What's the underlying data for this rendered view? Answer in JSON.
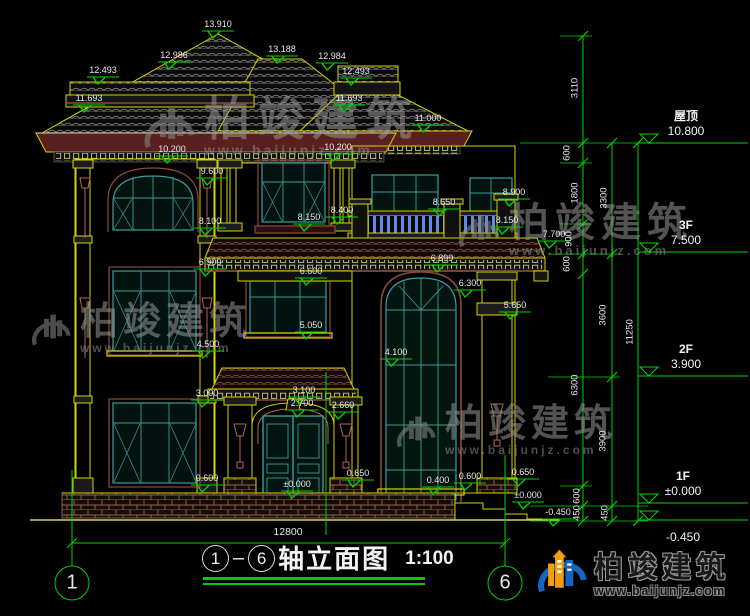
{
  "drawing_title": {
    "axis_from": "1",
    "axis_to": "6",
    "name": "轴立面图",
    "scale": "1:100"
  },
  "axis_bubbles": [
    {
      "label": "1",
      "x": 72,
      "y": 583
    },
    {
      "label": "6",
      "x": 505,
      "y": 583
    }
  ],
  "bottom_dimension": {
    "text": "12800"
  },
  "elevation_markers": [
    {
      "t": "13.910",
      "x": 218,
      "y": 25
    },
    {
      "t": "12.986",
      "x": 174,
      "y": 56
    },
    {
      "t": "13.188",
      "x": 282,
      "y": 50
    },
    {
      "t": "12.984",
      "x": 332,
      "y": 57
    },
    {
      "t": "12.493",
      "x": 103,
      "y": 71
    },
    {
      "t": "12.493",
      "x": 356,
      "y": 72
    },
    {
      "t": "11.693",
      "x": 89,
      "y": 99
    },
    {
      "t": "11.693",
      "x": 349,
      "y": 99
    },
    {
      "t": "11.000",
      "x": 428,
      "y": 119
    },
    {
      "t": "10.200",
      "x": 172,
      "y": 150
    },
    {
      "t": "10.200",
      "x": 338,
      "y": 148
    },
    {
      "t": "9.600",
      "x": 212,
      "y": 172
    },
    {
      "t": "8.100",
      "x": 210,
      "y": 222
    },
    {
      "t": "8.150",
      "x": 309,
      "y": 218
    },
    {
      "t": "8.400",
      "x": 342,
      "y": 211
    },
    {
      "t": "8.650",
      "x": 444,
      "y": 203
    },
    {
      "t": "8.900",
      "x": 514,
      "y": 193
    },
    {
      "t": "8.150",
      "x": 507,
      "y": 221
    },
    {
      "t": "7.700",
      "x": 554,
      "y": 235
    },
    {
      "t": "6.900",
      "x": 210,
      "y": 263
    },
    {
      "t": "6.899",
      "x": 442,
      "y": 259
    },
    {
      "t": "6.600",
      "x": 311,
      "y": 272
    },
    {
      "t": "6.300",
      "x": 470,
      "y": 284
    },
    {
      "t": "5.650",
      "x": 515,
      "y": 306
    },
    {
      "t": "5.050",
      "x": 311,
      "y": 326
    },
    {
      "t": "4.500",
      "x": 208,
      "y": 345
    },
    {
      "t": "4.100",
      "x": 396,
      "y": 353
    },
    {
      "t": "3.000",
      "x": 207,
      "y": 394
    },
    {
      "t": "3.100",
      "x": 304,
      "y": 391
    },
    {
      "t": "2.700",
      "x": 302,
      "y": 404
    },
    {
      "t": "2.660",
      "x": 343,
      "y": 406
    },
    {
      "t": "0.600",
      "x": 207,
      "y": 479
    },
    {
      "t": "0.650",
      "x": 358,
      "y": 474
    },
    {
      "t": "0.400",
      "x": 438,
      "y": 481
    },
    {
      "t": "0.600",
      "x": 470,
      "y": 477
    },
    {
      "t": "0.650",
      "x": 523,
      "y": 473
    },
    {
      "t": "±0.000",
      "x": 297,
      "y": 485
    },
    {
      "t": "±0.000",
      "x": 528,
      "y": 496
    },
    {
      "t": "-0.450",
      "x": 558,
      "y": 513
    }
  ],
  "level_markers": [
    {
      "name": "屋顶",
      "value": "10.800",
      "x": 686,
      "y": 143,
      "below": false
    },
    {
      "name": "3F",
      "value": "7.500",
      "x": 686,
      "y": 252,
      "below": false
    },
    {
      "name": "2F",
      "value": "3.900",
      "x": 686,
      "y": 376,
      "below": false
    },
    {
      "name": "1F",
      "value": "±0.000",
      "x": 683,
      "y": 503,
      "below": false
    },
    {
      "name": "",
      "value": "-0.450",
      "x": 683,
      "y": 520,
      "below": true
    }
  ],
  "dim_chain_labels": [
    {
      "t": "3110",
      "x": 575,
      "y": 88
    },
    {
      "t": "600",
      "x": 567,
      "y": 153
    },
    {
      "t": "1800",
      "x": 575,
      "y": 193
    },
    {
      "t": "900",
      "x": 569,
      "y": 239
    },
    {
      "t": "600",
      "x": 567,
      "y": 264
    },
    {
      "t": "6300",
      "x": 575,
      "y": 385
    },
    {
      "t": "600",
      "x": 577,
      "y": 496
    },
    {
      "t": "450",
      "x": 577,
      "y": 513
    },
    {
      "t": "3300",
      "x": 604,
      "y": 198
    },
    {
      "t": "3600",
      "x": 603,
      "y": 315
    },
    {
      "t": "3900",
      "x": 603,
      "y": 441
    },
    {
      "t": "450",
      "x": 605,
      "y": 513
    },
    {
      "t": "11250",
      "x": 630,
      "y": 332
    }
  ],
  "brand": {
    "company": "柏竣建筑",
    "website": "www.baijunjz.com"
  },
  "watermarks": [
    {
      "x": 142,
      "y": 96,
      "cn": 46,
      "url": 14,
      "logo": 54,
      "ls": 8
    },
    {
      "x": 457,
      "y": 203,
      "cn": 40,
      "url": 13,
      "logo": 44,
      "ls": 6
    },
    {
      "x": 30,
      "y": 303,
      "cn": 38,
      "url": 12,
      "logo": 42,
      "ls": 5
    },
    {
      "x": 395,
      "y": 405,
      "cn": 38,
      "url": 12,
      "logo": 42,
      "ls": 5
    }
  ],
  "colors": {
    "line_yellow": "#d4d400",
    "line_green": "#00d400",
    "window_teal": "#3d9b9b",
    "cornice_maroon": "#5a1f1f",
    "baluster_blue": "#5b8dee",
    "text_white": "#e8e8e8",
    "logo_blue": "#1565c0",
    "logo_orange": "#f59e0b"
  }
}
